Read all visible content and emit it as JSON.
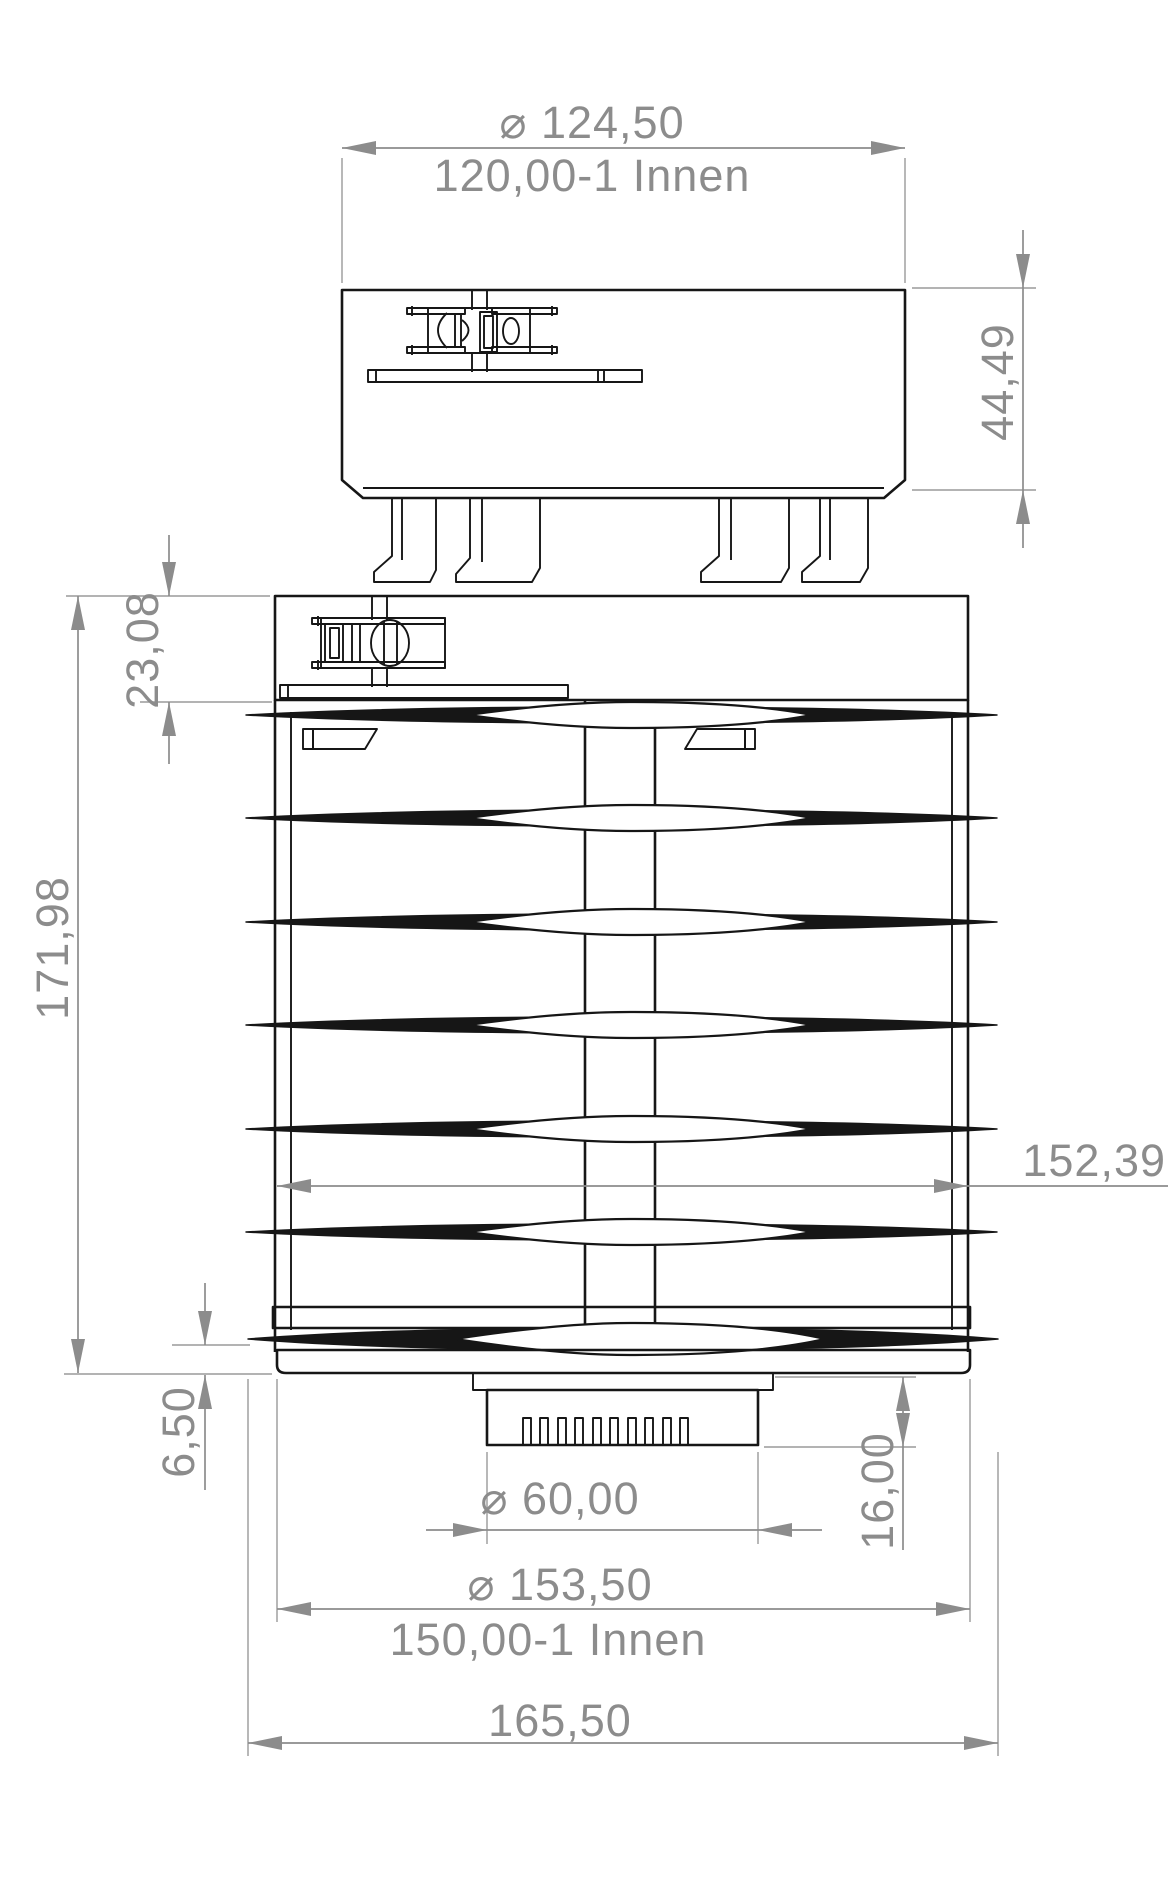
{
  "drawing": {
    "type": "technical-dimension-drawing",
    "colors": {
      "line": "#161616",
      "dimension": "#8c8c8c",
      "background": "#ffffff"
    },
    "dimensions": {
      "top_outer_diameter": "⌀ 124,50",
      "top_inner_diameter": "120,00-1 Innen",
      "top_part_height": "44,49",
      "collar_height": "23,08",
      "body_height": "171,98",
      "body_diameter": "152,39",
      "base_lip_height": "6,50",
      "connector_diameter": "⌀ 60,00",
      "connector_height": "16,00",
      "base_outer_diameter": "⌀ 153,50",
      "base_inner_diameter": "150,00-1 Innen",
      "overall_width": "165,50"
    }
  }
}
